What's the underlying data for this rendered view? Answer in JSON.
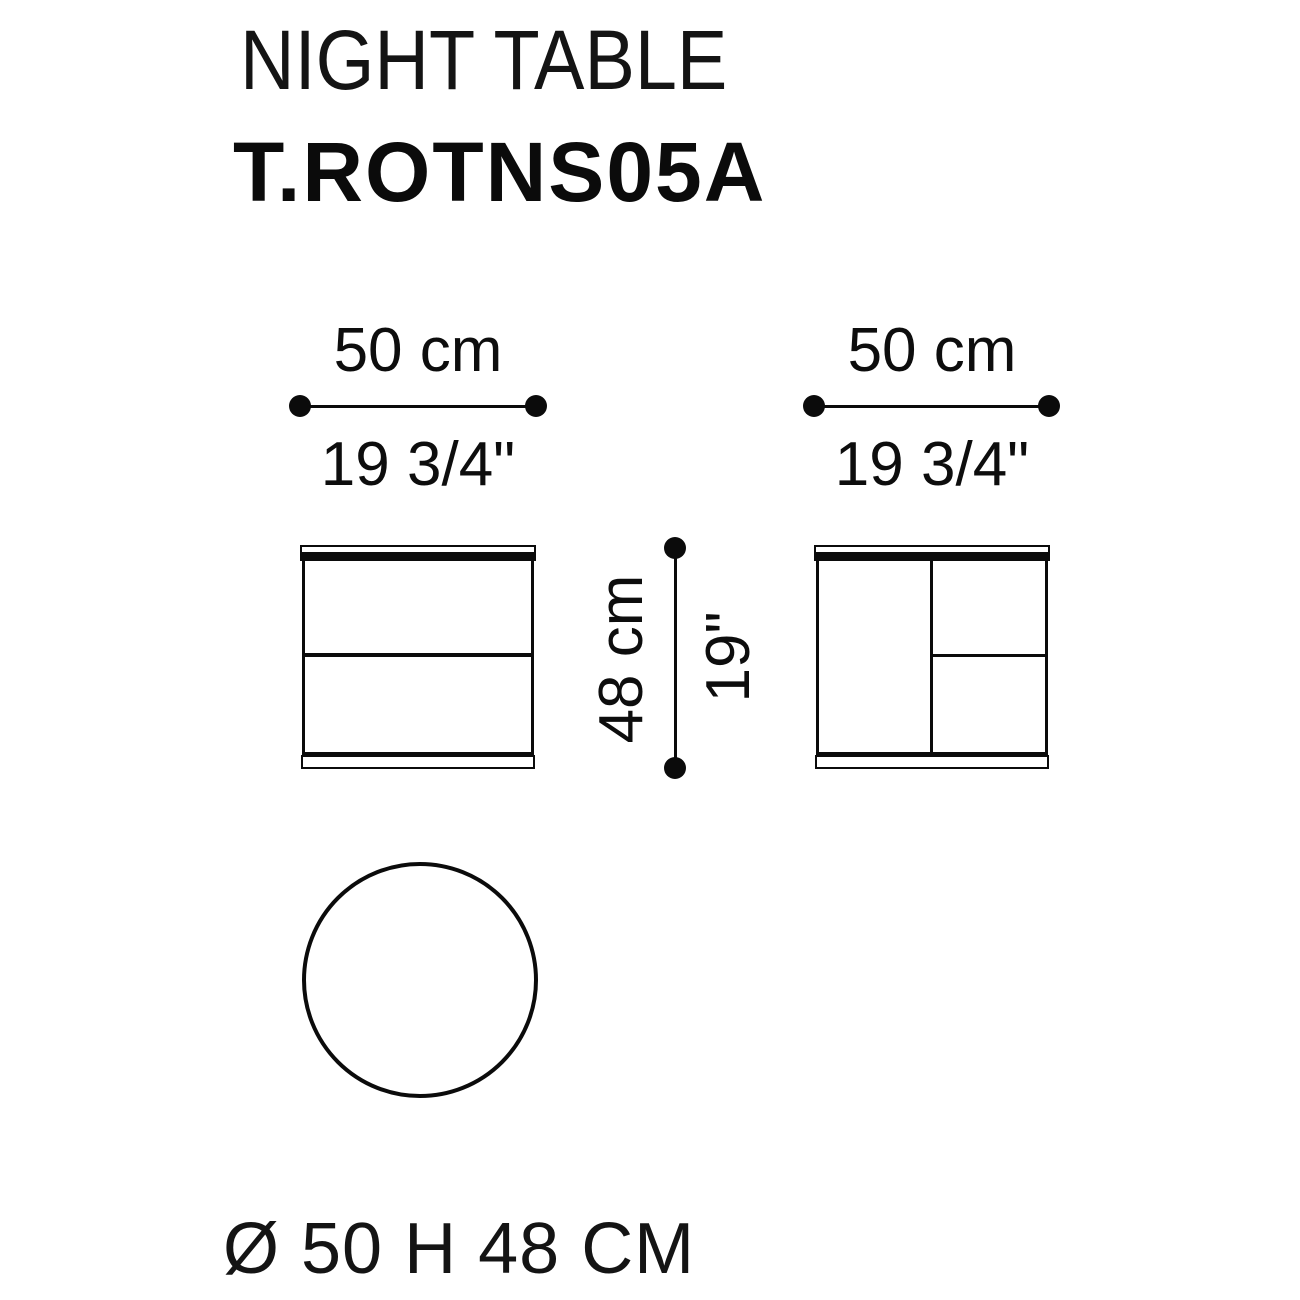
{
  "page": {
    "background_color": "#ffffff",
    "ink_color": "#0b0b0b"
  },
  "header": {
    "category": "NIGHT TABLE",
    "model": "T.ROTNS05A"
  },
  "dimensions": {
    "front_width": {
      "cm": "50 cm",
      "inches": "19 3/4\""
    },
    "side_depth": {
      "cm": "50 cm",
      "inches": "19 3/4\""
    },
    "height": {
      "cm": "48 cm",
      "inches": "19\""
    }
  },
  "views": {
    "front": "front elevation with two drawers",
    "side": "side elevation with panel and two sections",
    "top": "round top view"
  },
  "footer": {
    "summary": "Ø 50 H 48 CM"
  }
}
